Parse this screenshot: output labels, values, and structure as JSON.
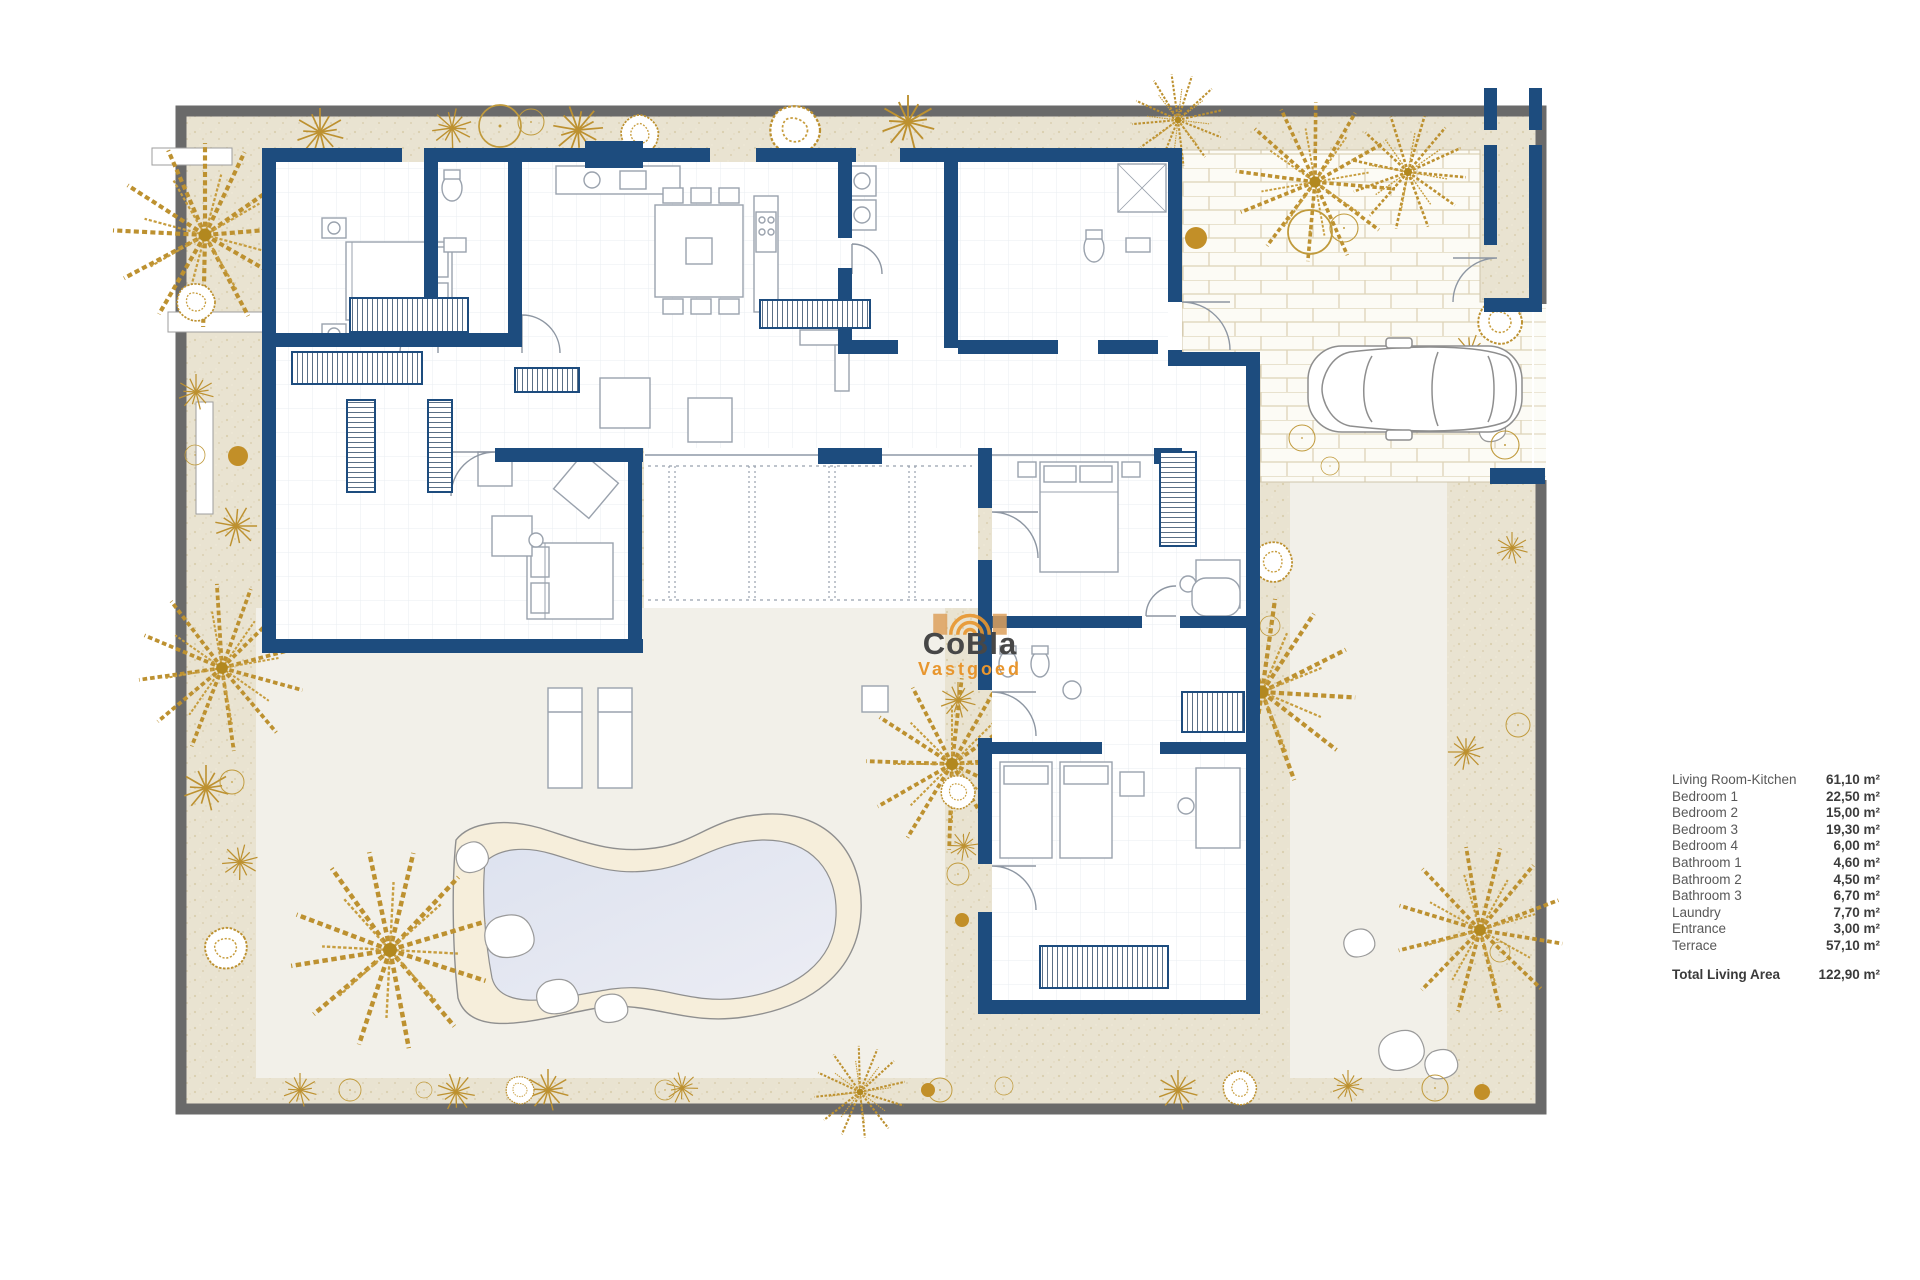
{
  "plan": {
    "watermark": {
      "brand": "CoBla",
      "sub": "Vastgoed"
    },
    "legend": {
      "rows": [
        {
          "label": "Living Room-Kitchen",
          "area": "61,10 m²"
        },
        {
          "label": "Bedroom 1",
          "area": "22,50 m²"
        },
        {
          "label": "Bedroom 2",
          "area": "15,00 m²"
        },
        {
          "label": "Bedroom 3",
          "area": "19,30 m²"
        },
        {
          "label": "Bedroom 4",
          "area": "6,00 m²"
        },
        {
          "label": "Bathroom 1",
          "area": "4,60 m²"
        },
        {
          "label": "Bathroom 2",
          "area": "4,50 m²"
        },
        {
          "label": "Bathroom 3",
          "area": "6,70 m²"
        },
        {
          "label": "Laundry",
          "area": "7,70 m²"
        },
        {
          "label": "Entrance",
          "area": "3,00 m²"
        },
        {
          "label": "Terrace",
          "area": "57,10 m²"
        }
      ],
      "total": {
        "label": "Total Living Area",
        "area": "122,90 m²"
      }
    },
    "colors": {
      "wall": "#1d4c7e",
      "gold": "#bd9130",
      "orange": "#e8962e",
      "frame": "#6a6a6a"
    }
  }
}
